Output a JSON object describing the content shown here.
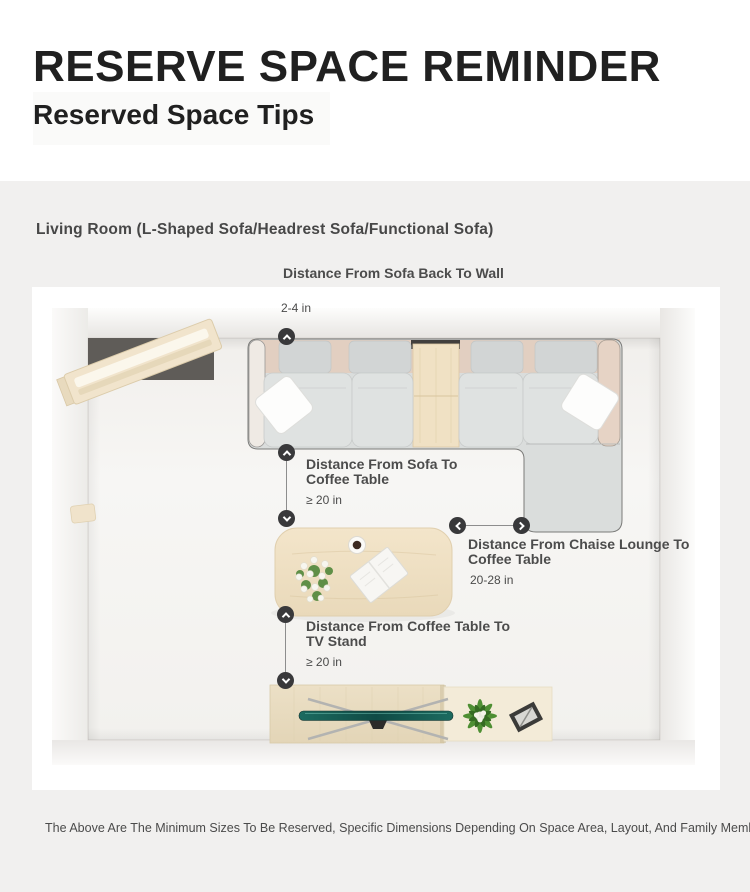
{
  "header": {
    "title": "RESERVE SPACE REMINDER",
    "subtitle": "Reserved Space Tips"
  },
  "section": {
    "title": "Living Room (L-Shaped Sofa/Headrest Sofa/Functional Sofa)"
  },
  "annotations": [
    {
      "id": "sofa-back-to-wall",
      "label": "Distance From Sofa Back To Wall",
      "value": "2-4 in",
      "connector": "up"
    },
    {
      "id": "sofa-to-coffee-table",
      "label": "Distance From Sofa To Coffee Table",
      "value": "≥ 20 in",
      "connector": "vertical"
    },
    {
      "id": "chaise-to-coffee-table",
      "label": "Distance From Chaise Lounge To Coffee Table",
      "value": "20-28 in",
      "connector": "horizontal"
    },
    {
      "id": "coffee-table-to-tv",
      "label": "Distance From Coffee Table To TV Stand",
      "value": "≥ 20 in",
      "connector": "vertical"
    }
  ],
  "footer": {
    "disclaimer": "The Above Are The Minimum Sizes To Be Reserved, Specific Dimensions Depending On Space Area, Layout, And Family Member Needs."
  },
  "colors": {
    "page_bg": "#f1f0ef",
    "card_bg": "#ffffff",
    "heading": "#202020",
    "annotation_text": "#4c4c4c",
    "marker": "#39393b",
    "sofa_gray": "#d9dcdb",
    "accent_beige": "#e2cfc1",
    "wood": "#f0e1c4",
    "tv_teal": "#1c6b60"
  }
}
